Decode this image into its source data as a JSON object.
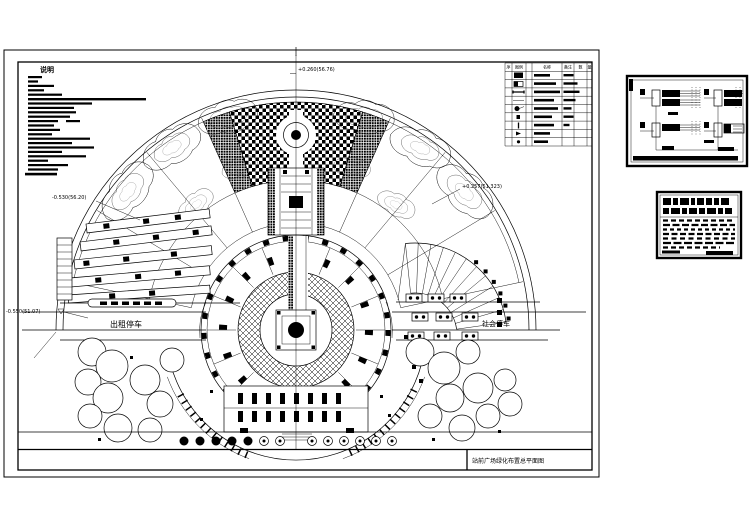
{
  "page": {
    "background": "#ffffff",
    "line_color": "#000000"
  },
  "main_sheet": {
    "notes": {
      "title": "说明"
    },
    "legend": {
      "headers": [
        "序",
        "图例",
        "名称",
        "备注",
        "数",
        "量"
      ]
    },
    "elevations": {
      "top": "+0.260(56.76)",
      "left": "-0.530(56.20)",
      "right": "+0.257(51.323)",
      "bottom_left": "-0.550(51.07)"
    },
    "labels": {
      "taxi_parking": "出租停车",
      "public_parking": "社会停车"
    },
    "title_block": {
      "drawing_title": "站前广场绿化布置总平面图"
    }
  }
}
